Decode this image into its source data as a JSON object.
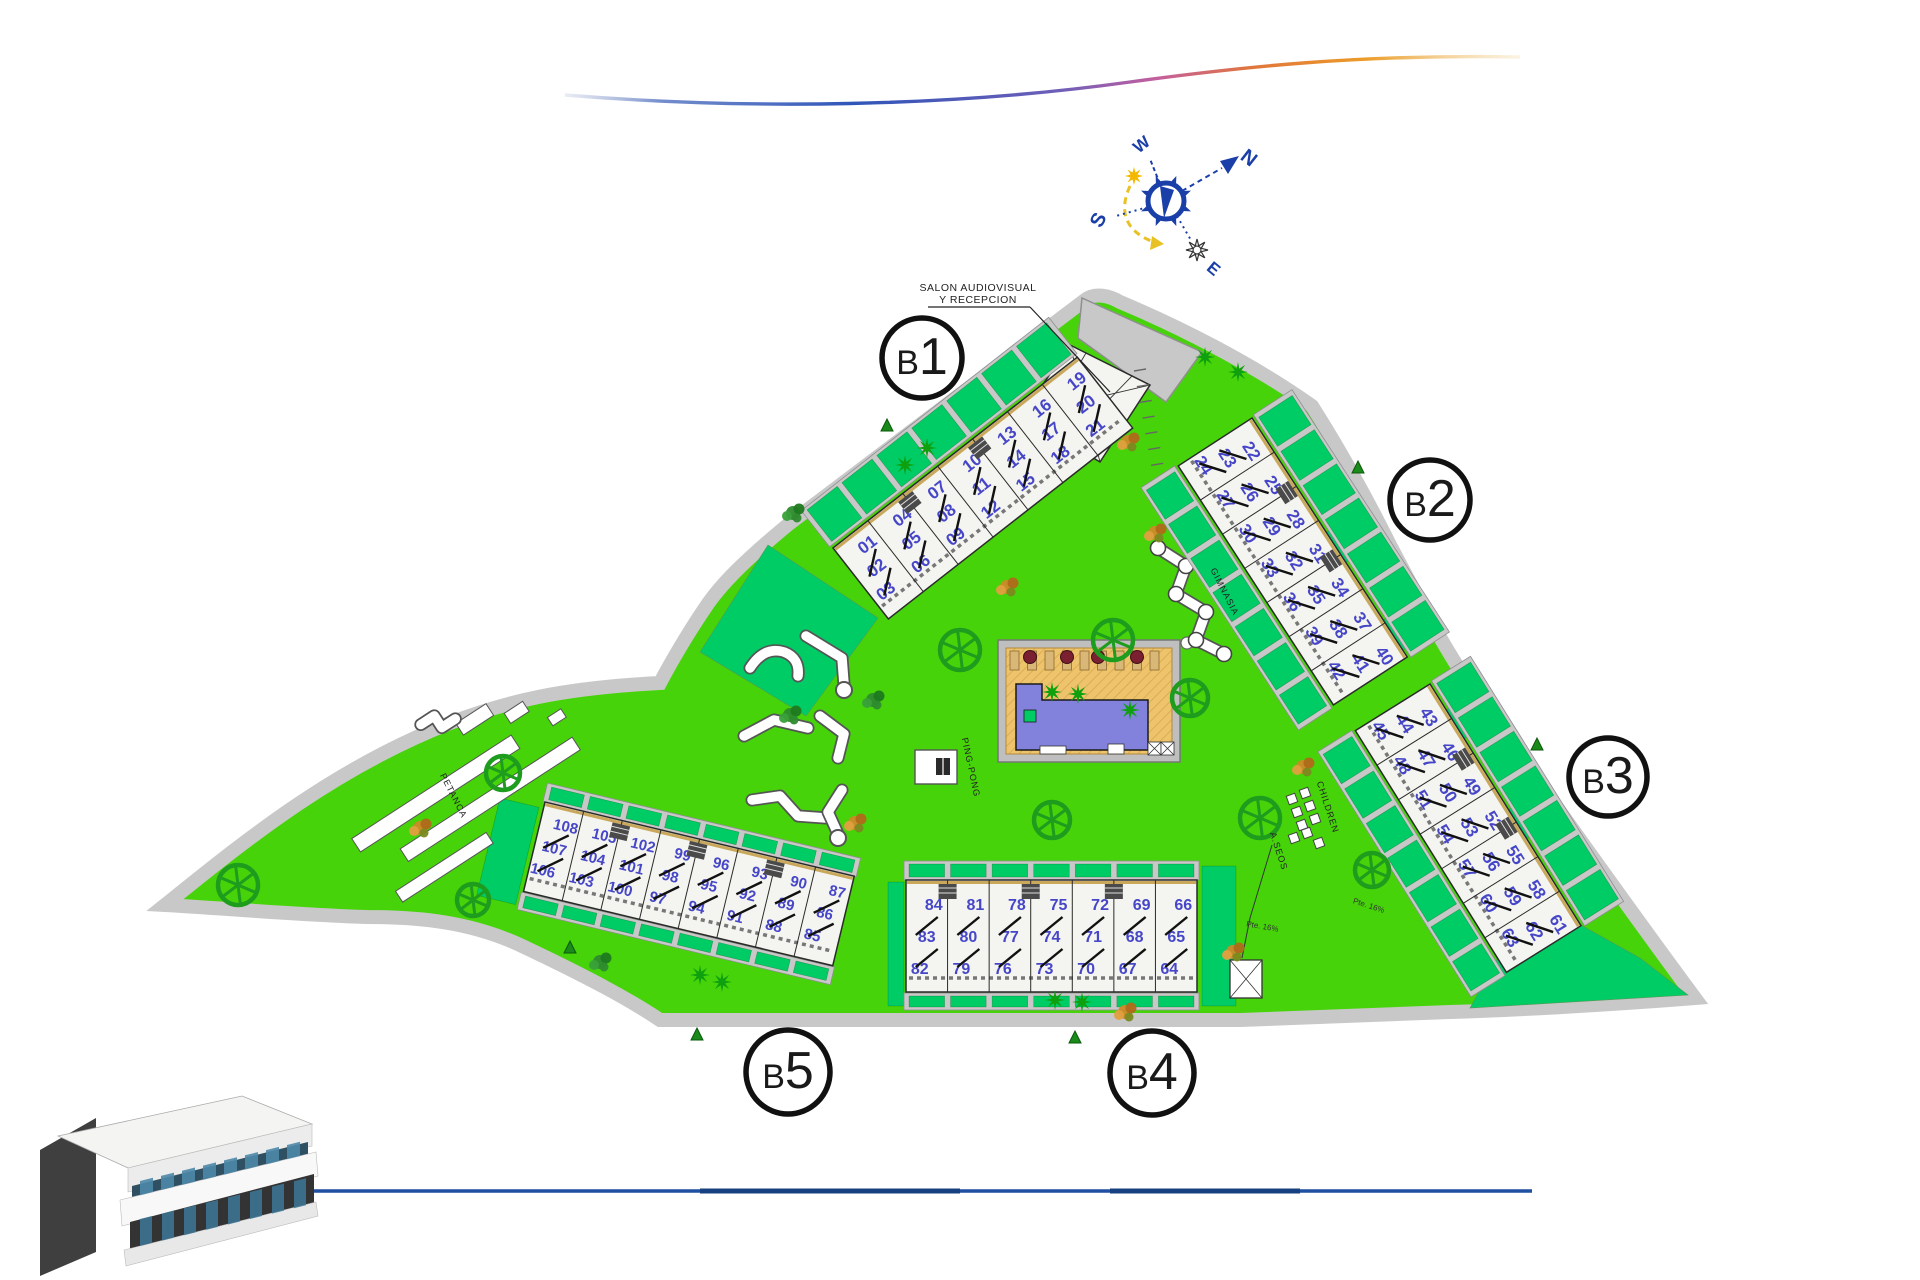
{
  "plan_type": "residential site plan",
  "compass": {
    "north": "N",
    "south": "S",
    "east": "E",
    "west": "W"
  },
  "labels": {
    "reception_line1": "SALON AUDIOVISUAL",
    "reception_line2": "Y RECEPCION",
    "gym": "GIMNASIA",
    "children": "CHILDREN",
    "petanca": "PETANCA",
    "pingpong": "PING-PONG",
    "aseos": "A.SEOS",
    "ramp1": "Pte. 16%",
    "ramp2": "Pte. 16%"
  },
  "blocks": [
    {
      "id": "b1",
      "label": "B1",
      "units": [
        [
          "01",
          "02",
          "03"
        ],
        [
          "04",
          "05",
          "06"
        ],
        [
          "07",
          "08",
          "09"
        ],
        [
          "10",
          "11",
          "12"
        ],
        [
          "13",
          "14",
          "15"
        ],
        [
          "16",
          "17",
          "18"
        ],
        [
          "19",
          "20",
          "21"
        ]
      ]
    },
    {
      "id": "b2",
      "label": "B2",
      "units": [
        [
          "22",
          "23",
          "24"
        ],
        [
          "25",
          "26",
          "27"
        ],
        [
          "28",
          "29",
          "30"
        ],
        [
          "31",
          "32",
          "33"
        ],
        [
          "34",
          "35",
          "36"
        ],
        [
          "37",
          "38",
          "39"
        ],
        [
          "40",
          "41",
          "42"
        ]
      ]
    },
    {
      "id": "b3",
      "label": "B3",
      "units": [
        [
          "43",
          "44",
          "45"
        ],
        [
          "46",
          "47",
          "48"
        ],
        [
          "49",
          "50",
          "51"
        ],
        [
          "52",
          "53",
          "54"
        ],
        [
          "55",
          "56",
          "57"
        ],
        [
          "58",
          "59",
          "60"
        ],
        [
          "61",
          "62",
          "63"
        ]
      ]
    },
    {
      "id": "b4",
      "label": "B4",
      "units": [
        [
          "84",
          "83",
          "82"
        ],
        [
          "81",
          "80",
          "79"
        ],
        [
          "78",
          "77",
          "76"
        ],
        [
          "75",
          "74",
          "73"
        ],
        [
          "72",
          "71",
          "70"
        ],
        [
          "69",
          "68",
          "67"
        ],
        [
          "66",
          "65",
          "64"
        ]
      ]
    },
    {
      "id": "b5",
      "label": "B5",
      "units": [
        [
          "108",
          "107",
          "106"
        ],
        [
          "105",
          "104",
          "103"
        ],
        [
          "102",
          "101",
          "100"
        ],
        [
          "99",
          "98",
          "97"
        ],
        [
          "96",
          "95",
          "94"
        ],
        [
          "93",
          "92",
          "91"
        ],
        [
          "90",
          "89",
          "88"
        ],
        [
          "87",
          "86",
          "85"
        ]
      ]
    }
  ],
  "colors": {
    "lawn": "#46D309",
    "garden": "#00CC66",
    "boundary": "#9B30C9",
    "road": "#C8C8C8",
    "roadEdge": "#8F8F8F",
    "bldg": "#F4F4F0",
    "bldgEdge": "#2A2A2A",
    "terraceTan": "#C9A85C",
    "unitNumber": "#4646C8",
    "poolWater": "#8282DC",
    "poolDeck": "#EDC36B",
    "deckHatch": "#D8A84E",
    "parasol": "#7A2030",
    "sunbed": "#D9B877",
    "treeGreen": "#1E9C1E",
    "palmGreen": "#0FA00F",
    "shrubOrange": "#CC8A28",
    "compassBlue": "#1B3FA8",
    "sunYellow": "#F5B800",
    "swooshBlue": "#2F55B8",
    "swooshPink": "#C45F9E",
    "swooshOrange": "#E0763C",
    "bottomLine": "#1E4FA0"
  }
}
